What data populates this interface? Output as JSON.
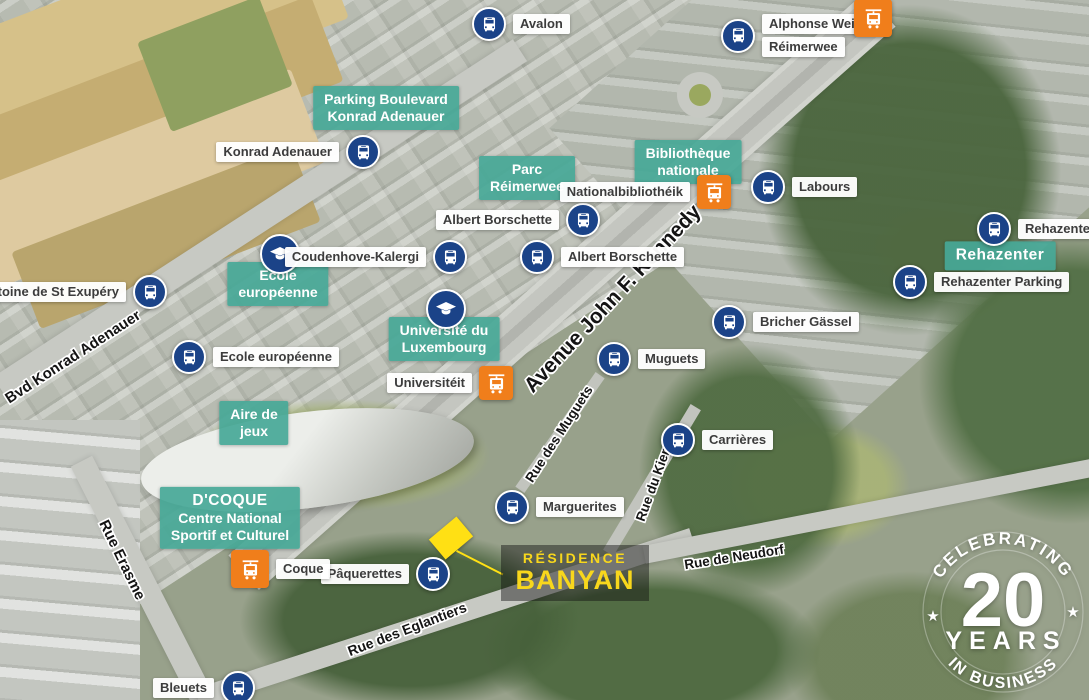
{
  "transit": {
    "bus_stops": [
      {
        "name": "Avalon"
      },
      {
        "name": "Alphonse Weicker",
        "name2": "Réimerwee"
      },
      {
        "name": "Konrad Adenauer"
      },
      {
        "name": "Labours"
      },
      {
        "name": "Albert Borschette"
      },
      {
        "name": "Albert Borschette"
      },
      {
        "name": "Rehazenter"
      },
      {
        "name": "Rehazenter Parking"
      },
      {
        "name": "Antoine de St Exupéry"
      },
      {
        "name": "Coudenhove-Kalergi"
      },
      {
        "name": "Ecole européenne"
      },
      {
        "name": "Muguets"
      },
      {
        "name": "Bricher Gässel"
      },
      {
        "name": "Carrières"
      },
      {
        "name": "Marguerites"
      },
      {
        "name": "Pâquerettes"
      },
      {
        "name": "Bleuets"
      }
    ],
    "tram_stops": [
      {
        "name": "Nationalbibliothéik"
      },
      {
        "name": "Universitéit"
      },
      {
        "name": "Coque"
      }
    ]
  },
  "pois": {
    "parking": {
      "l1": "Parking Boulevard",
      "l2": "Konrad Adenauer"
    },
    "parc": {
      "l1": "Parc",
      "l2": "Réimerwee"
    },
    "bibliotheque": {
      "l1": "Bibliothèque",
      "l2": "nationale"
    },
    "ecole": {
      "l1": "Ecole",
      "l2": "européenne"
    },
    "universite": {
      "l1": "Université du",
      "l2": "Luxembourg"
    },
    "rehazenter": {
      "l1": "Rehazenter"
    },
    "aire": {
      "l1": "Aire de",
      "l2": "jeux"
    },
    "dcoque": {
      "l1": "D'COQUE",
      "l2": "Centre National",
      "l3": "Sportif et Culturel"
    }
  },
  "streets": [
    "Avenue John F. Kennedy",
    "Bvd Konrad Adenauer",
    "Rue Erasme",
    "Rue des Muguets",
    "Rue du Kiem",
    "Rue de Neudorf",
    "Rue des Eglantiers"
  ],
  "residence": {
    "line1": "RÉSIDENCE",
    "line2": "BANYAN"
  },
  "badge": {
    "arc_top": "CELEBRATING",
    "number": "20",
    "years": "YEARS",
    "arc_bottom": "IN BUSINESS"
  },
  "icons": {
    "bus": "bus-icon",
    "tram": "tram-icon",
    "school": "graduation-cap-icon",
    "star_glyph": "★"
  },
  "colors": {
    "teal": "#46A897",
    "bus_blue": "#1B4388",
    "tram_orange": "#F07E1B",
    "banyan_yellow": "#F8D71C",
    "marker_yellow": "#FFE014"
  }
}
